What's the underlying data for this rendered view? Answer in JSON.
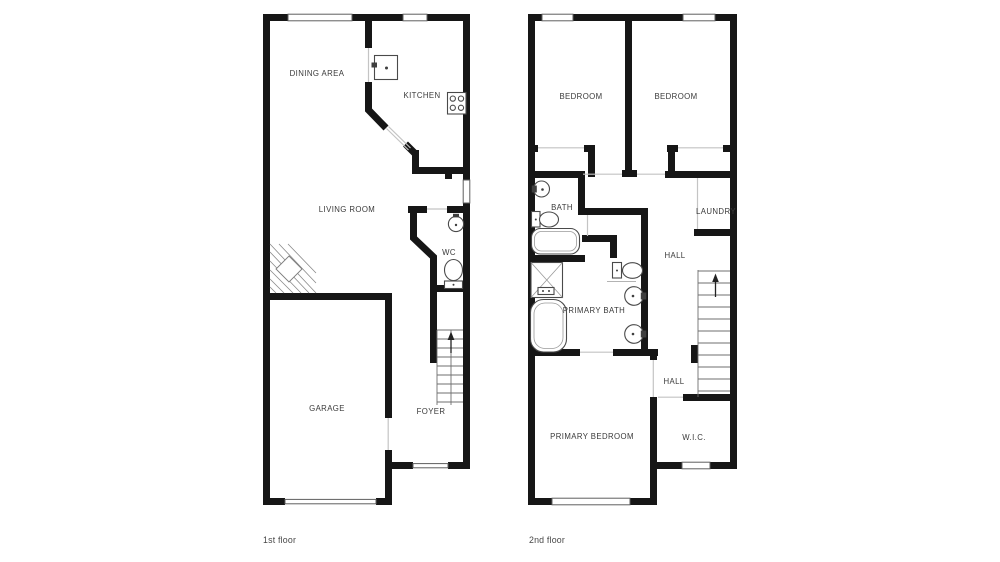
{
  "document": {
    "type": "floor-plan",
    "background": "#ffffff"
  },
  "colors": {
    "wall": "#161616",
    "door_opening_line": "#c4c4c4",
    "fixture_outline": "#4a4a4a",
    "label_text": "#3a3a3a",
    "caption_text": "#474747"
  },
  "floors": [
    {
      "caption": "1st floor",
      "rooms": [
        {
          "label": "DINING AREA"
        },
        {
          "label": "KITCHEN"
        },
        {
          "label": "LIVING ROOM"
        },
        {
          "label": "WC"
        },
        {
          "label": "GARAGE"
        },
        {
          "label": "FOYER"
        }
      ],
      "fixtures": [
        "kitchen-sink-icon",
        "stove-icon",
        "wc-sink-icon",
        "wc-toilet-icon",
        "winder-stairs-icon",
        "staircase-up-icon",
        "garage-door",
        "front-door-opening",
        "windows"
      ]
    },
    {
      "caption": "2nd floor",
      "rooms": [
        {
          "label": "BEDROOM"
        },
        {
          "label": "BEDROOM"
        },
        {
          "label": "BATH"
        },
        {
          "label": "LAUNDRY"
        },
        {
          "label": "HALL"
        },
        {
          "label": "PRIMARY BATH"
        },
        {
          "label": "HALL"
        },
        {
          "label": "PRIMARY BEDROOM"
        },
        {
          "label": "W.I.C."
        }
      ],
      "fixtures": [
        "bath-sink-icon",
        "bath-toilet-icon",
        "bathtub-icon",
        "shower-icon",
        "freestanding-tub-icon",
        "primary-toilet-icon",
        "vanity-sink-icon",
        "vanity-sink-icon",
        "staircase-up-icon",
        "windows"
      ]
    }
  ]
}
